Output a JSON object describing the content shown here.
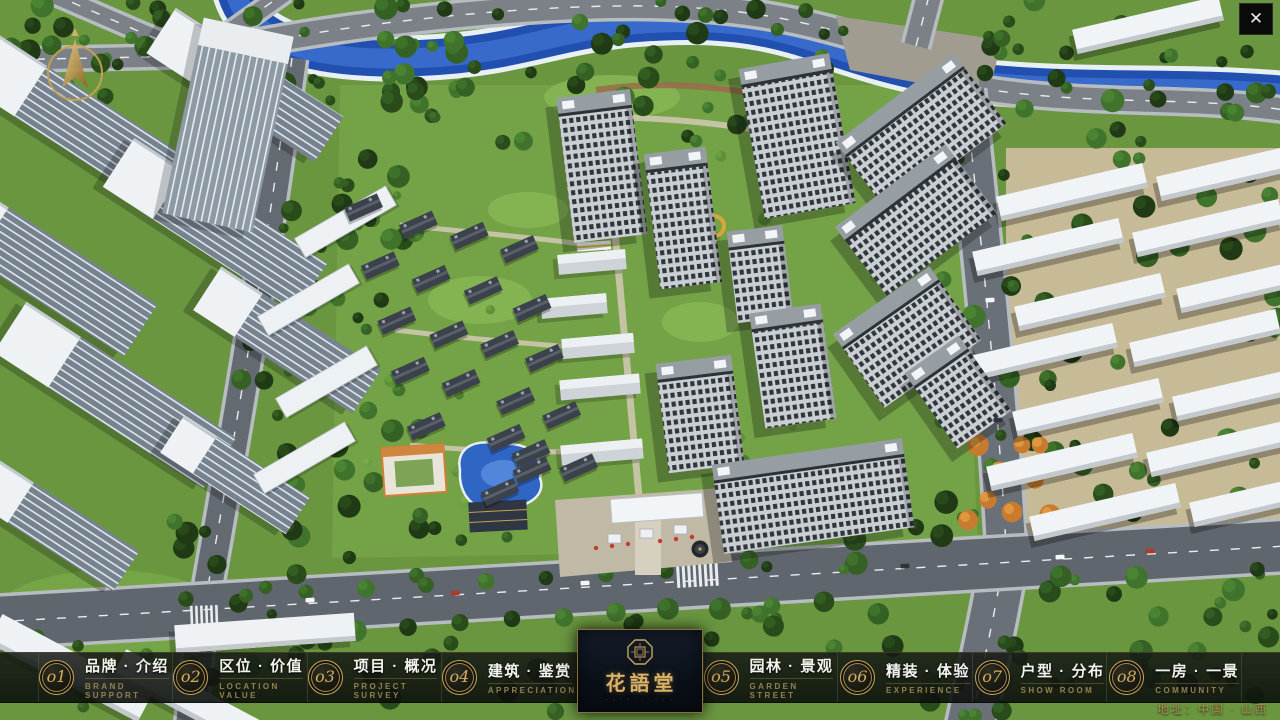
{
  "scene": {
    "label": "residential-masterplan-aerial-view"
  },
  "icons": {
    "close": "✕",
    "compass": "north-arrow",
    "seal": "octagon-seal"
  },
  "menu": {
    "items": [
      {
        "num": "o1",
        "zh": "品牌 · 介绍",
        "en": "BRAND SUPPORT"
      },
      {
        "num": "o2",
        "zh": "区位 · 价值",
        "en": "LOCATION VALUE"
      },
      {
        "num": "o3",
        "zh": "项目 · 概况",
        "en": "PROJECT SURVEY"
      },
      {
        "num": "o4",
        "zh": "建筑 · 鉴赏",
        "en": "APPRECIATION"
      },
      {
        "num": "o5",
        "zh": "园林 · 景观",
        "en": "GARDEN STREET"
      },
      {
        "num": "o6",
        "zh": "精装 · 体验",
        "en": "EXPERIENCE"
      },
      {
        "num": "o7",
        "zh": "户型 · 分布",
        "en": "SHOW ROOM"
      },
      {
        "num": "o8",
        "zh": "一房 · 一景",
        "en": "COMMUNITY"
      }
    ]
  },
  "logo": {
    "title": "花語堂",
    "subtitle": "· · · · · · · · · ·"
  },
  "address": {
    "label": "地址：中国 · 山西"
  },
  "colors": {
    "gold": "#c9a45c",
    "water": "#2b50c8",
    "bar_bg": "rgba(15,19,15,0.86)",
    "title_gold": "#d8b269"
  }
}
